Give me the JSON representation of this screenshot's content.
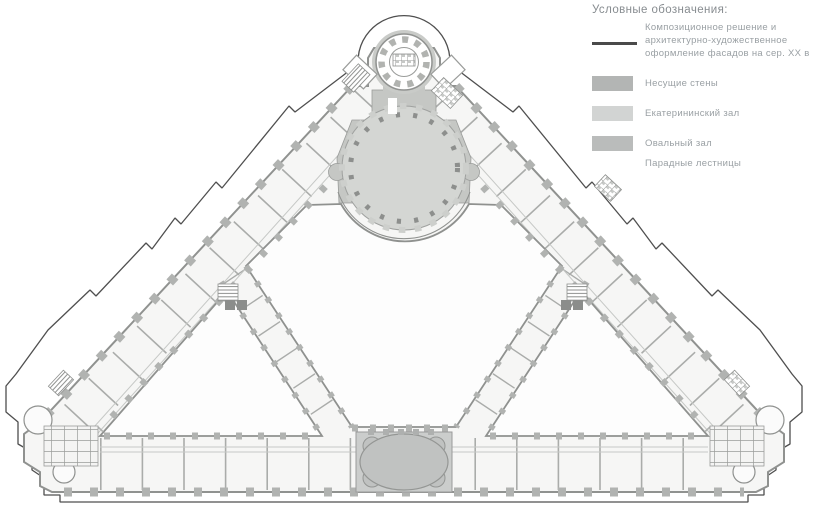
{
  "legend": {
    "title": "Условные обозначения:",
    "facade_item": {
      "line_color": "#4a4a4a",
      "lines": [
        "Композиционное решение и",
        "архитектурно-художественное",
        "оформление фасадов на сер. XX в"
      ]
    },
    "items": [
      {
        "label": "Несущие стены",
        "color": "#b3b5b4"
      },
      {
        "label": "Екатерининский зал",
        "color": "#d2d4d3"
      },
      {
        "label": "Овальный зал",
        "color": "#babcbb"
      },
      {
        "label": "Парадные лестницы",
        "color": ""
      }
    ]
  },
  "colors": {
    "facade_line": "#4f4f4f",
    "wall_stroke": "#8f918f",
    "bearing_walls": "#b3b5b4",
    "hall_surround": "#c5c7c4",
    "ekaterininsky_hall": "#d4d6d3",
    "oval_hall": "#c0c2c1",
    "text_gray": "#9aa0a4",
    "title_gray": "#878c90"
  }
}
